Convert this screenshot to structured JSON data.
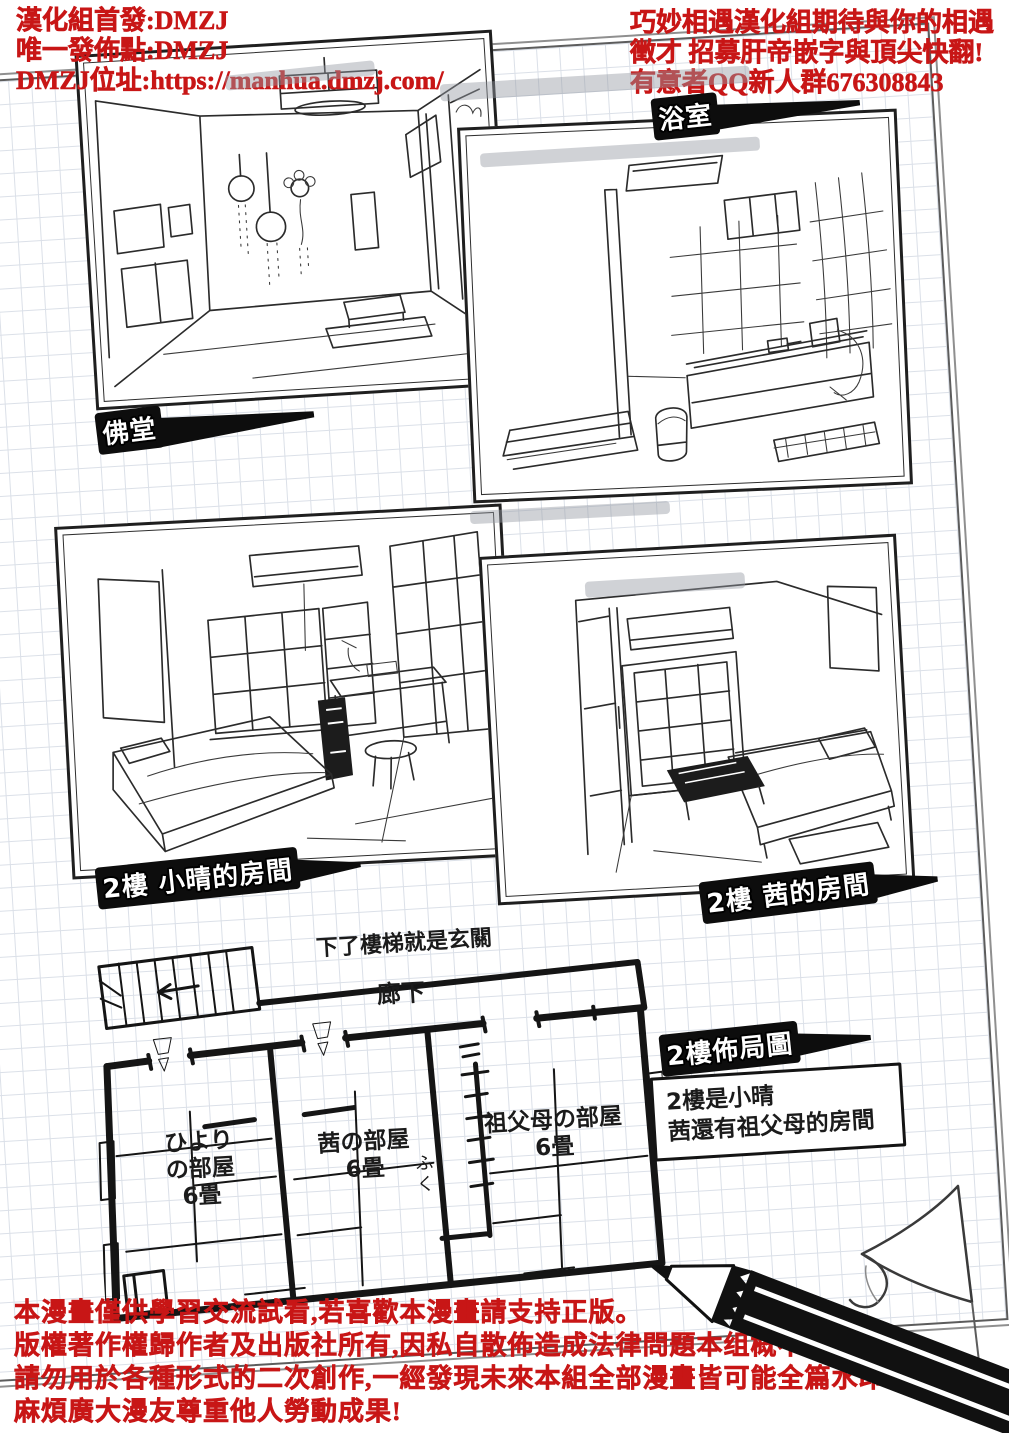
{
  "colors": {
    "accent_red": "#c81616",
    "ink": "#1a1a1a",
    "grid_line": "#dbe0e8",
    "highlight": "rgba(150,156,164,0.45)"
  },
  "credits_left": {
    "line1": "漢化組首發:DMZJ",
    "line2": "唯一發佈點:DMZJ",
    "line3": "DMZJ位址:https://manhua.dmzj.com/"
  },
  "recruit_right": {
    "line1": "巧妙相遇漢化組期待與你的相遇",
    "line2": "徵才 招募肝帝嵌字與頂尖快翻!",
    "line3": "有意者QQ新人群676308843"
  },
  "room_tags": {
    "bathroom": "浴室",
    "altar": "佛堂",
    "koharu": "2樓 小晴的房間",
    "akane": "2樓 茜的房間",
    "layout": "2樓佈局圖"
  },
  "floor_plan": {
    "stairs_note": "下了樓梯就是玄關",
    "corridor": "廊下",
    "hiyori_room": {
      "line1": "ひより",
      "line2": "の部屋",
      "line3": "6畳"
    },
    "akane_room": {
      "line1": "茜の部屋",
      "line2": "6畳"
    },
    "grandparents_room": {
      "line1": "祖父母の部屋",
      "line2": "6畳"
    },
    "closet": "ふく"
  },
  "note_box": {
    "line1": "2樓是小晴",
    "line2": "茜還有祖父母的房間"
  },
  "disclaimer": {
    "line1": "本漫畫僅供學習交流試看,若喜歡本漫畫請支持正版。",
    "line2": "版權著作權歸作者及出版社所有,因私自散佈造成法律問題本组概不負責。",
    "line3": "請勿用於各種形式的二次創作,一經發現未來本組全部漫畫皆可能全篇水印。",
    "line4": "麻煩廣大漫友尊重他人勞動成果!"
  }
}
